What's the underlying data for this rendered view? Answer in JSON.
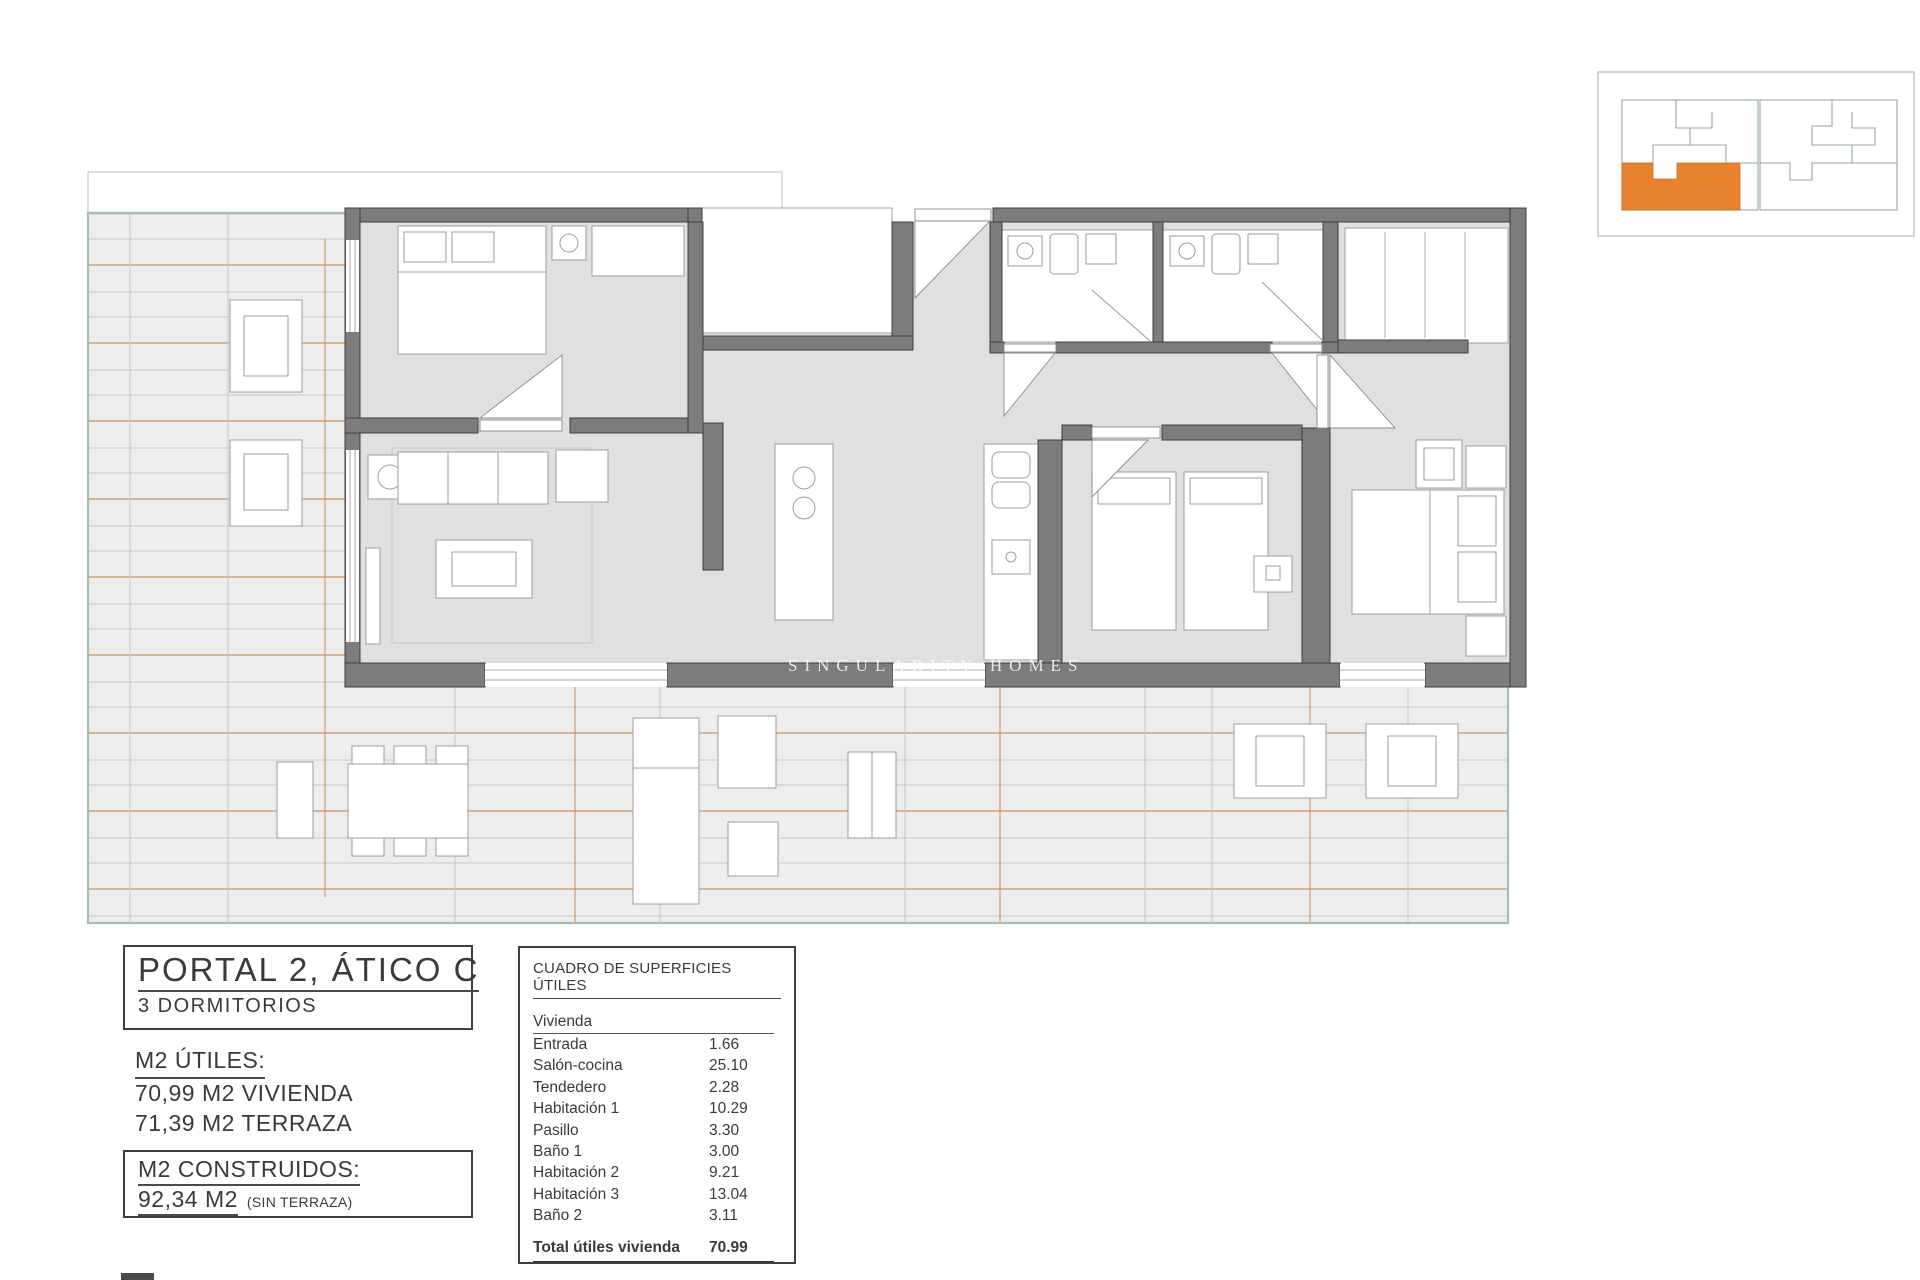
{
  "plan": {
    "watermark": "SINGULARITY HOMES"
  },
  "title_block": {
    "title": "PORTAL 2, ÁTICO C",
    "subtitle": "3 DORMITORIOS"
  },
  "m2_utiles": {
    "label": "M2 ÚTILES:",
    "line1": "70,99 M2 VIVIENDA",
    "line2": "71,39 M2 TERRAZA"
  },
  "m2_construidos": {
    "label": "M2 CONSTRUIDOS:",
    "value": "92,34 M2",
    "note": "(SIN TERRAZA)"
  },
  "surface_table": {
    "title": "CUADRO DE SUPERFICIES ÚTILES",
    "group": "Vivienda",
    "rows": [
      {
        "label": "Entrada",
        "value": "1.66"
      },
      {
        "label": "Salón-cocina",
        "value": "25.10"
      },
      {
        "label": "Tendedero",
        "value": "2.28"
      },
      {
        "label": "Habitación 1",
        "value": "10.29"
      },
      {
        "label": "Pasillo",
        "value": "3.30"
      },
      {
        "label": "Baño 1",
        "value": "3.00"
      },
      {
        "label": "Habitación 2",
        "value": "9.21"
      },
      {
        "label": "Habitación 3",
        "value": "13.04"
      },
      {
        "label": "Baño 2",
        "value": "3.11"
      }
    ],
    "total_label": "Total útiles vivienda",
    "total_value": "70.99"
  },
  "colors": {
    "accent_orange": "#E8822E",
    "deck_orange": "#CD9460",
    "boundary_green": "#A3BFAF",
    "wall_gray": "#7C7C7C"
  }
}
